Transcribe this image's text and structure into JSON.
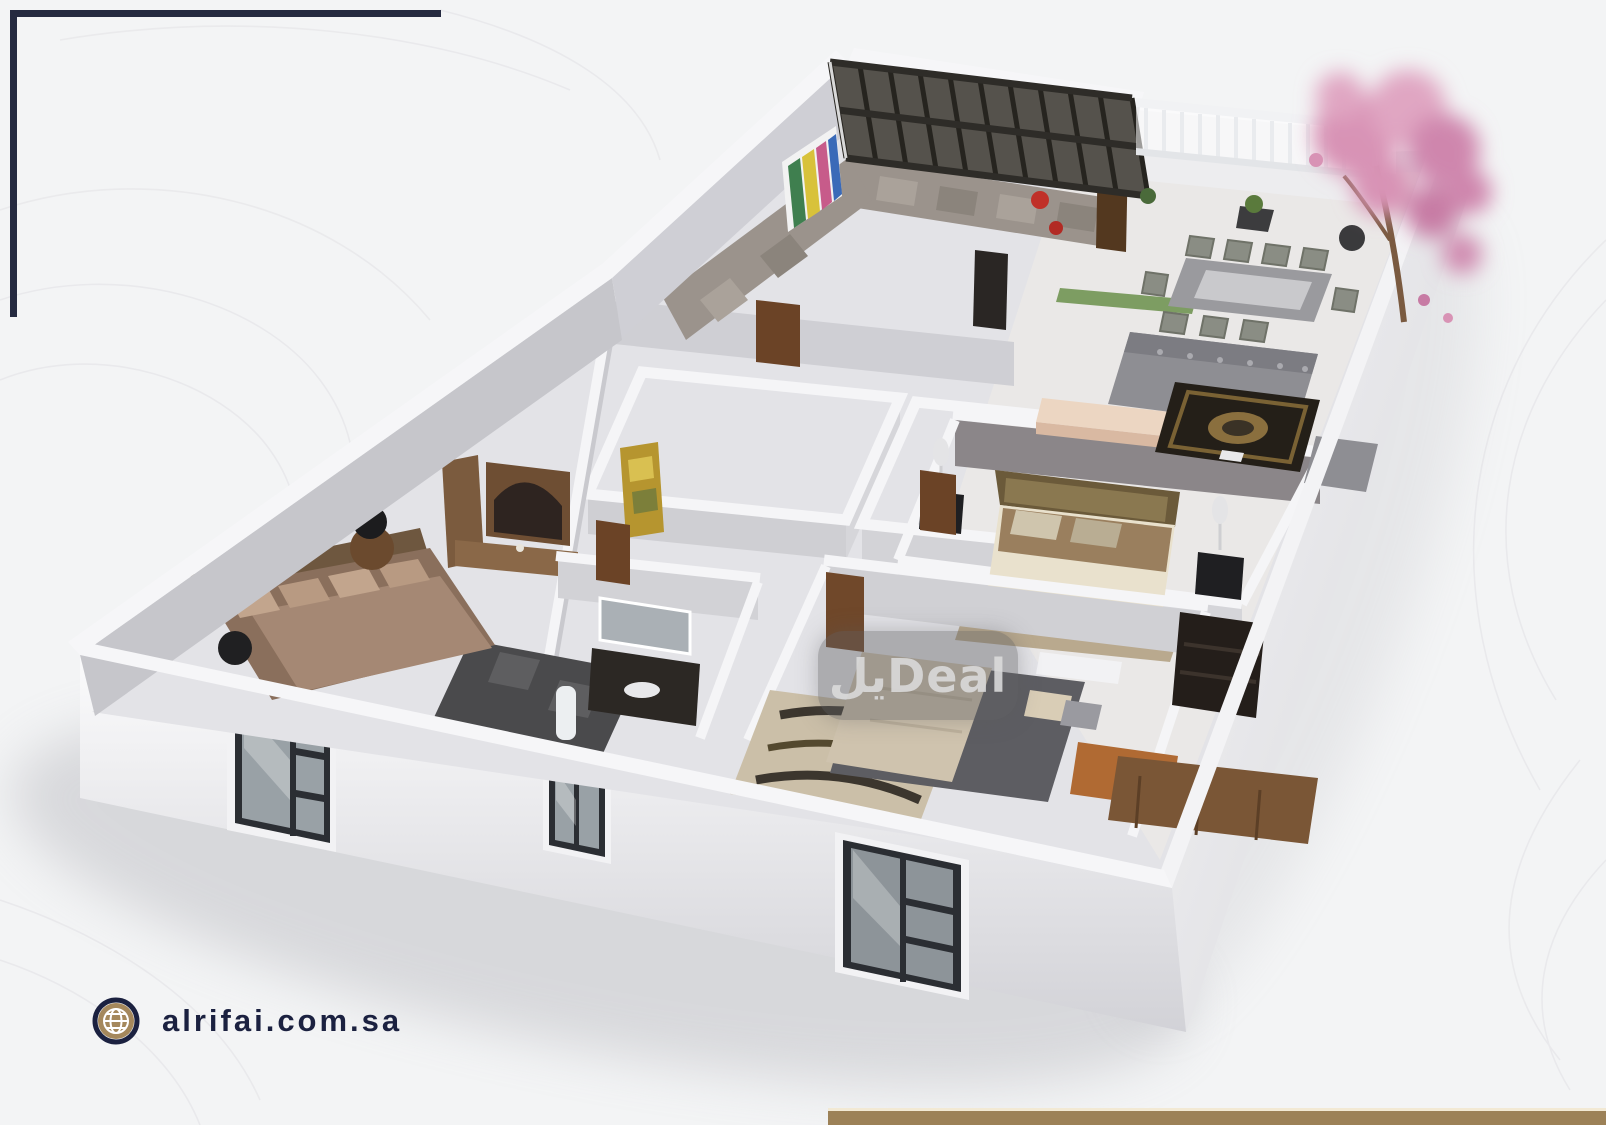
{
  "page": {
    "background": "#f3f4f5"
  },
  "brand": {
    "watermark_text": "يلDeal",
    "website": "alrifai.com.sa",
    "colors": {
      "navy": "#1b2140",
      "tan": "#a08457",
      "cream_line": "#f2e9d4",
      "watermark_bg": "rgba(95,95,97,0.42)",
      "watermark_text_color": "#dcdcdc"
    }
  },
  "icons": [
    {
      "name": "globe-icon",
      "meaning": "website link marker"
    }
  ],
  "scene": {
    "type": "3d-floor-plan-render",
    "rooms": [
      "majlis-lounge",
      "open-living-dining",
      "terrace-garden",
      "master-bedroom",
      "bedroom-2",
      "bedroom-3",
      "bathroom",
      "hallway-closets"
    ],
    "features": [
      "pergola-skylight",
      "balcony-railing",
      "cherry-blossom-tree",
      "front-windows",
      "wood-doors",
      "area-rugs",
      "prayer-rug"
    ]
  }
}
